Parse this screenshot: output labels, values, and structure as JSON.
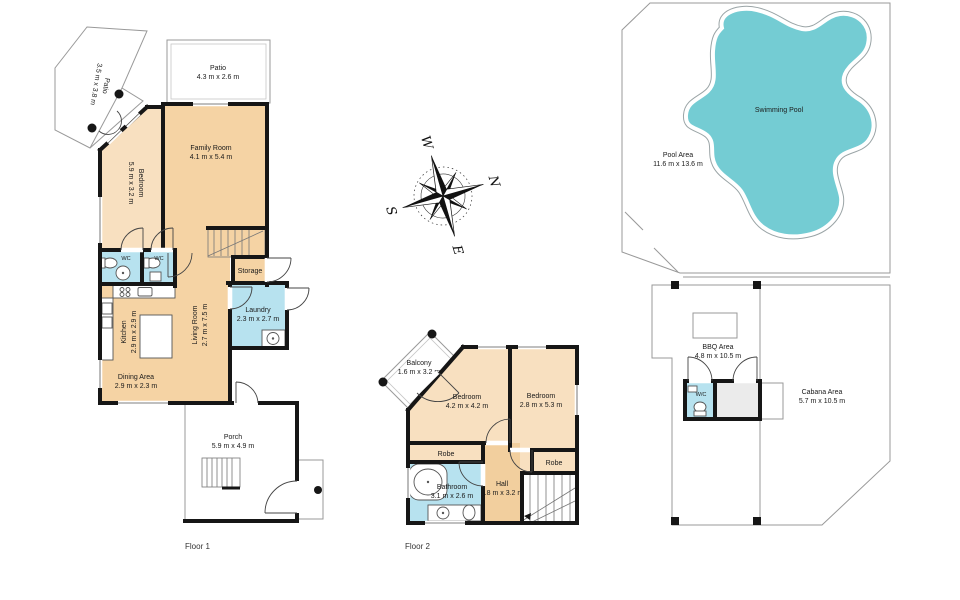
{
  "floor1": {
    "label": "Floor 1",
    "patio_side": {
      "name": "Patio",
      "dims": "3.5 m x 3.8 m"
    },
    "patio_top": {
      "name": "Patio",
      "dims": "4.3 m x 2.6 m"
    },
    "bedroom": {
      "name": "Bedroom",
      "dims": "5.9 m x 3.2 m"
    },
    "family_room": {
      "name": "Family Room",
      "dims": "4.1 m x 5.4 m"
    },
    "wc1": {
      "name": "WC"
    },
    "wc2": {
      "name": "WC"
    },
    "storage": {
      "name": "Storage"
    },
    "laundry": {
      "name": "Laundry",
      "dims": "2.3 m x 2.7 m"
    },
    "kitchen": {
      "name": "Kitchen",
      "dims": "2.9 m x 2.9 m"
    },
    "living_room": {
      "name": "Living Room",
      "dims": "2.7 m x 7.5 m"
    },
    "dining": {
      "name": "Dining Area",
      "dims": "2.9 m x 2.3 m"
    },
    "porch": {
      "name": "Porch",
      "dims": "5.9 m x 4.9 m"
    }
  },
  "floor2": {
    "label": "Floor 2",
    "balcony": {
      "name": "Balcony",
      "dims": "1.6 m x 3.2 m"
    },
    "bedroom1": {
      "name": "Bedroom",
      "dims": "4.2 m x 4.2 m"
    },
    "bedroom2": {
      "name": "Bedroom",
      "dims": "2.8 m x 5.3 m"
    },
    "robe1": {
      "name": "Robe"
    },
    "robe2": {
      "name": "Robe"
    },
    "bathroom": {
      "name": "Bathroom",
      "dims": "3.1 m x 2.6 m"
    },
    "hall": {
      "name": "Hall",
      "dims": "1.8 m x 3.2 m"
    }
  },
  "outdoor": {
    "swimming_pool": {
      "name": "Swimming Pool"
    },
    "pool_area": {
      "name": "Pool Area",
      "dims": "11.6 m x 13.6 m"
    },
    "bbq_area": {
      "name": "BBQ Area",
      "dims": "4.8 m x 10.5 m"
    },
    "wc": {
      "name": "W/C"
    },
    "cabana": {
      "name": "Cabana Area",
      "dims": "5.7 m x 10.5 m"
    }
  },
  "compass": {
    "north": "N",
    "south": "S",
    "east": "E",
    "west": "W"
  },
  "colors": {
    "room_peach": "#f5d3a4",
    "room_light_peach": "#f8e0c0",
    "wet_room_blue": "#b7e2ef",
    "outdoor_gray": "#e3e3e3",
    "pool_teal": "#74ccd3",
    "wall_black": "#161616"
  }
}
